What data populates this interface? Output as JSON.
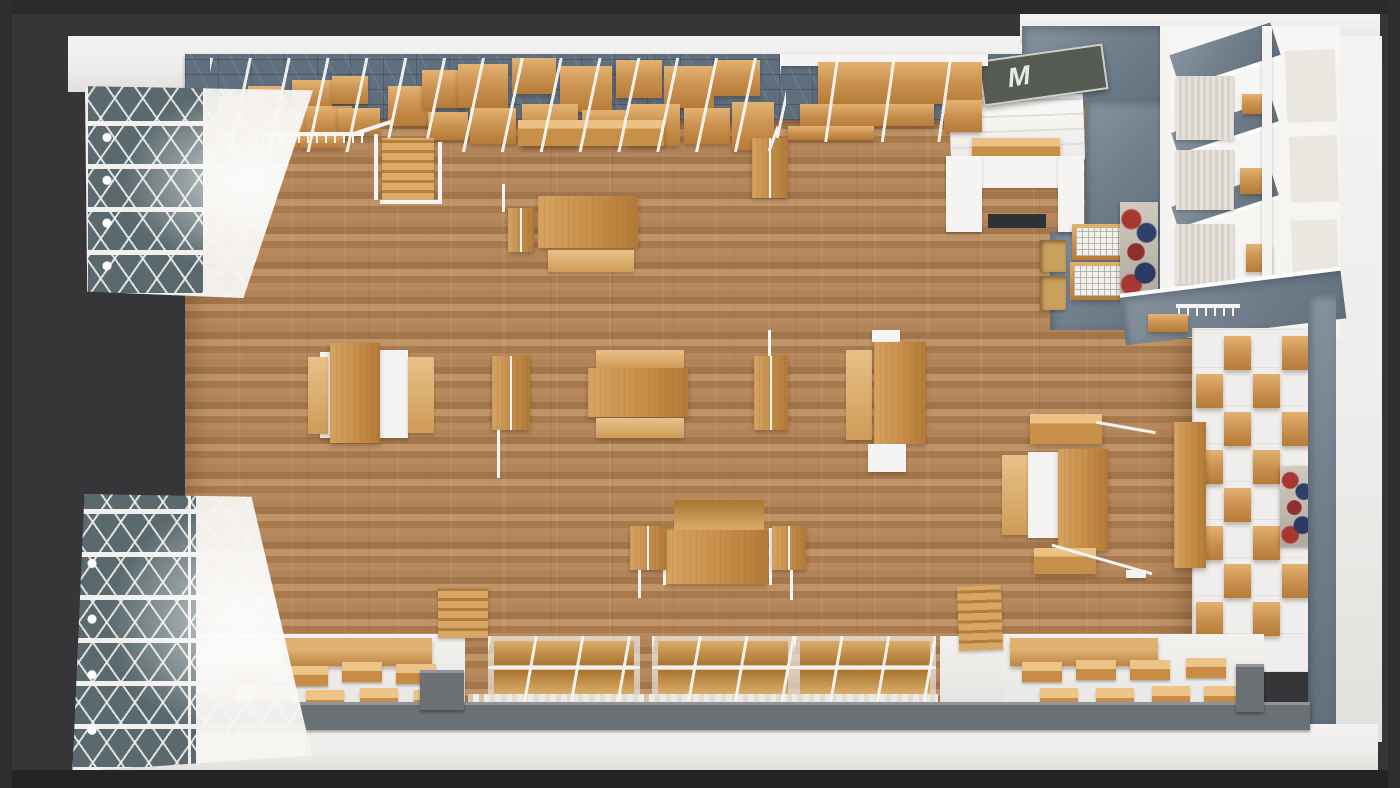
{
  "sign": {
    "letter": "M"
  },
  "palette": {
    "background": "#363638",
    "frame_dark": "#2b2b2d",
    "outer_white": "#edecea",
    "floor_wood": "#b0845a",
    "furniture_wood": "#c8904b",
    "furniture_wood_light": "#e3b271",
    "furniture_wood_dark": "#a9752f",
    "tile_walkway": "#5d6d7c",
    "slate_wall": "#73808d",
    "parapet_gray": "#6b7075",
    "glass_teal": "#59696e",
    "lattice_white": "#f1f0ed",
    "fixture_white": "#f5f4f2",
    "platform_white": "#efeeeb",
    "corridor_white": "#f5f4f1",
    "sign_face": "#565b53",
    "sign_letter": "#e9ebe7",
    "poster_red": "#a63732",
    "poster_navy": "#31406b",
    "poster_frame": "#6d5130",
    "mat_dark": "#2e3135"
  }
}
